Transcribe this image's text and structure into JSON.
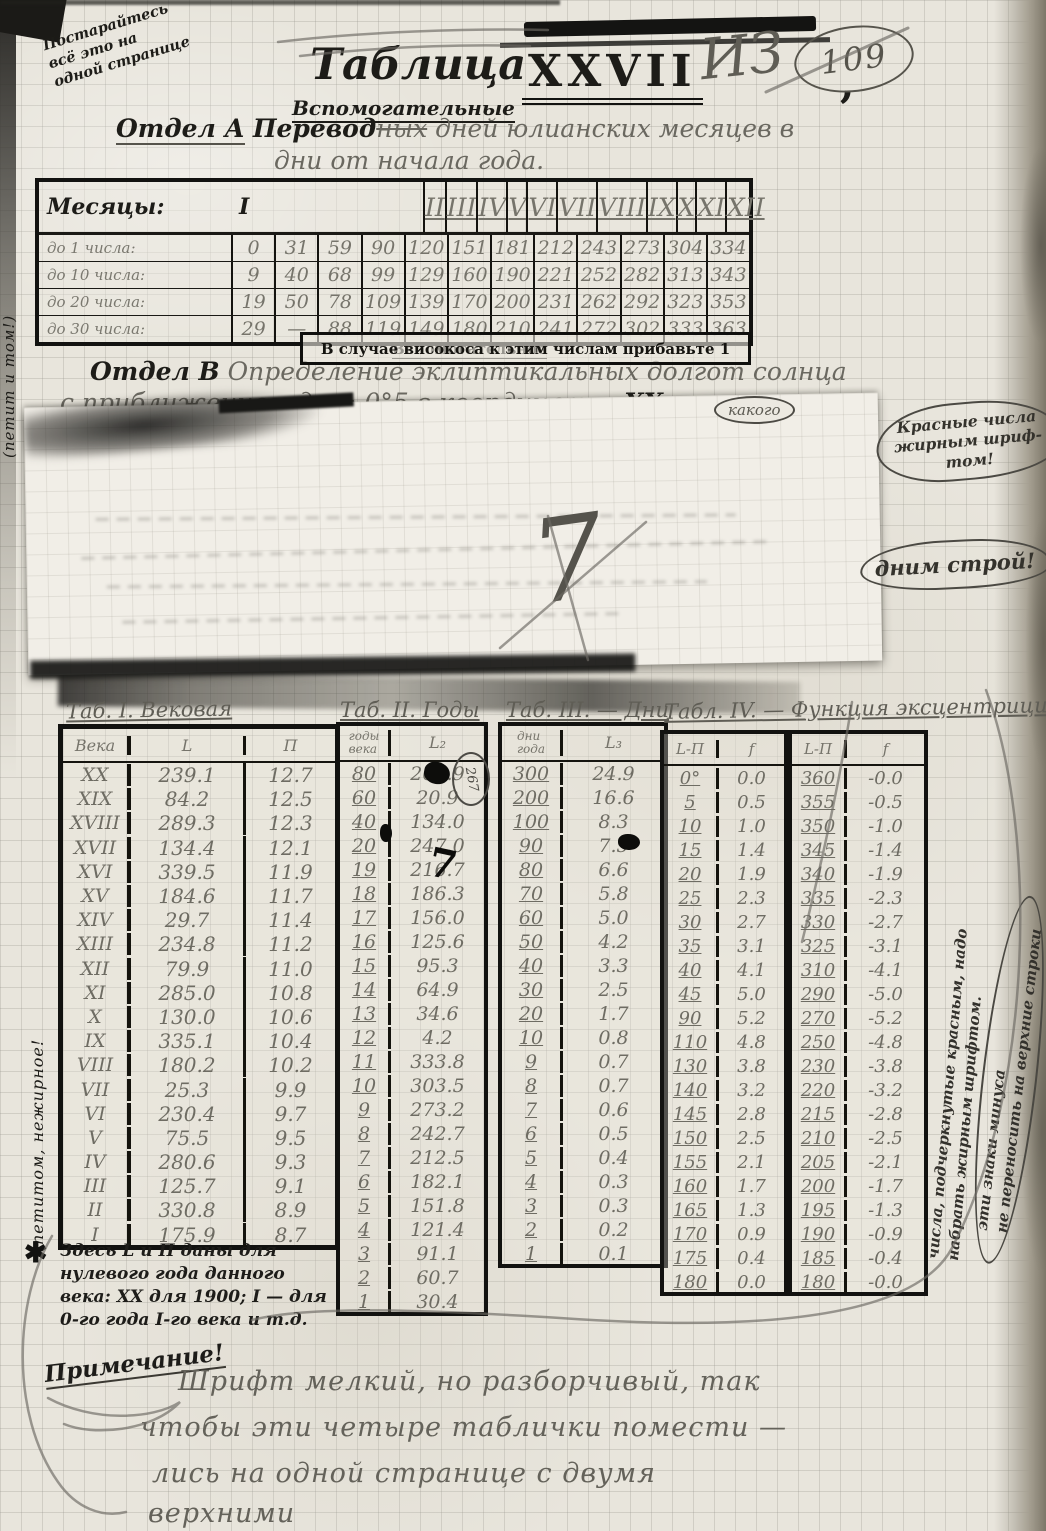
{
  "colors": {
    "paper": "#e8e5dc",
    "ink": "#1d1c18",
    "pencil": "#6a6860"
  },
  "margin_notes": {
    "top_left": "Постарайтесь\nвсё это на\nодной странице",
    "left_vertical_top": "(петит и том!)",
    "left_vertical_mid": "петитом, нежирное!",
    "red_numbers": "Красные числа\nжирным шриф-\nтом!",
    "stroy": "дним строй!",
    "right_line1": "числа, подчеркнутые красным, надо",
    "right_line2": "набрать жирным шрифтом.",
    "right_circled": "эти знаки минуса\nне переносить на верхние строки"
  },
  "header": {
    "title_word": "Таблица",
    "title_number": "XXVII",
    "title_comma": ",",
    "subtitle": "Вспомогательные",
    "pencil_iz": "ИЗ",
    "circled_number": "109",
    "section_a": {
      "prefix": "Отдел А",
      "inserted": "Перевод",
      "struck": "ных",
      "rest": "дней юлианских месяцев в",
      "line2": "дни от начала года."
    },
    "section_b": {
      "inserted": "Вспомогательное",
      "prefix": "Отдел В",
      "line1_rest": "Определение эклиптикальных долгот солнца",
      "line2_a": "с приближением до ± 0°5 в координатах",
      "struck": "XX",
      "line2_b": "века",
      "bubble": "какого"
    }
  },
  "table_a": {
    "corner_label": "Месяцы:",
    "months": [
      "I",
      "II",
      "III",
      "IV",
      "V",
      "VI",
      "VII",
      "VIII",
      "IX",
      "X",
      "XI",
      "XII"
    ],
    "rows": [
      {
        "label": "до 1 числа:",
        "values": [
          "0",
          "31",
          "59",
          "90",
          "120",
          "151",
          "181",
          "212",
          "243",
          "273",
          "304",
          "334"
        ]
      },
      {
        "label": "до 10 числа:",
        "values": [
          "9",
          "40",
          "68",
          "99",
          "129",
          "160",
          "190",
          "221",
          "252",
          "282",
          "313",
          "343"
        ]
      },
      {
        "label": "до 20 числа:",
        "values": [
          "19",
          "50",
          "78",
          "109",
          "139",
          "170",
          "200",
          "231",
          "262",
          "292",
          "323",
          "353"
        ]
      },
      {
        "label": "до 30 числа:",
        "values": [
          "29",
          "—",
          "88",
          "119",
          "149",
          "180",
          "210",
          "241",
          "272",
          "302",
          "333",
          "363"
        ]
      }
    ],
    "leap_note": "В случае високоса к этим числам прибавьте 1"
  },
  "strip": {
    "scribble": "7"
  },
  "table1": {
    "title": "Таб. I. Вековая",
    "headers": [
      "Века",
      "L",
      "П"
    ],
    "rows": [
      [
        "XX",
        "239.1",
        "12.7"
      ],
      [
        "XIX",
        "84.2",
        "12.5"
      ],
      [
        "XVIII",
        "289.3",
        "12.3"
      ],
      [
        "XVII",
        "134.4",
        "12.1"
      ],
      [
        "XVI",
        "339.5",
        "11.9"
      ],
      [
        "XV",
        "184.6",
        "11.7"
      ],
      [
        "XIV",
        "29.7",
        "11.4"
      ],
      [
        "XIII",
        "234.8",
        "11.2"
      ],
      [
        "XII",
        "79.9",
        "11.0"
      ],
      [
        "XI",
        "285.0",
        "10.8"
      ],
      [
        "X",
        "130.0",
        "10.6"
      ],
      [
        "IX",
        "335.1",
        "10.4"
      ],
      [
        "VIII",
        "180.2",
        "10.2"
      ],
      [
        "VII",
        "25.3",
        "9.9"
      ],
      [
        "VI",
        "230.4",
        "9.7"
      ],
      [
        "V",
        "75.5",
        "9.5"
      ],
      [
        "IV",
        "280.6",
        "9.3"
      ],
      [
        "III",
        "125.7",
        "9.1"
      ],
      [
        "II",
        "330.8",
        "8.9"
      ],
      [
        "I",
        "175.9",
        "8.7"
      ]
    ]
  },
  "table2": {
    "title": "Таб. II. Годы",
    "headers": [
      "годы\nвека",
      "L₂"
    ],
    "annotation": "267",
    "rows": [
      [
        "80",
        "267.9"
      ],
      [
        "60",
        "20.9"
      ],
      [
        "40",
        "134.0"
      ],
      [
        "20",
        "247.0"
      ],
      [
        "19",
        "216.7"
      ],
      [
        "18",
        "186.3"
      ],
      [
        "17",
        "156.0"
      ],
      [
        "16",
        "125.6"
      ],
      [
        "15",
        "95.3"
      ],
      [
        "14",
        "64.9"
      ],
      [
        "13",
        "34.6"
      ],
      [
        "12",
        "4.2"
      ],
      [
        "11",
        "333.8"
      ],
      [
        "10",
        "303.5"
      ],
      [
        "9",
        "273.2"
      ],
      [
        "8",
        "242.7"
      ],
      [
        "7",
        "212.5"
      ],
      [
        "6",
        "182.1"
      ],
      [
        "5",
        "151.8"
      ],
      [
        "4",
        "121.4"
      ],
      [
        "3",
        "91.1"
      ],
      [
        "2",
        "60.7"
      ],
      [
        "1",
        "30.4"
      ]
    ]
  },
  "table3": {
    "title": "Таб. III. — Дни",
    "headers": [
      "дни\nгода",
      "L₃"
    ],
    "rows": [
      [
        "300",
        "24.9"
      ],
      [
        "200",
        "16.6"
      ],
      [
        "100",
        "8.3"
      ],
      [
        "90",
        "7.5"
      ],
      [
        "80",
        "6.6"
      ],
      [
        "70",
        "5.8"
      ],
      [
        "60",
        "5.0"
      ],
      [
        "50",
        "4.2"
      ],
      [
        "40",
        "3.3"
      ],
      [
        "30",
        "2.5"
      ],
      [
        "20",
        "1.7"
      ],
      [
        "10",
        "0.8"
      ],
      [
        "9",
        "0.7"
      ],
      [
        "8",
        "0.7"
      ],
      [
        "7",
        "0.6"
      ],
      [
        "6",
        "0.5"
      ],
      [
        "5",
        "0.4"
      ],
      [
        "4",
        "0.3"
      ],
      [
        "3",
        "0.3"
      ],
      [
        "2",
        "0.2"
      ],
      [
        "1",
        "0.1"
      ]
    ]
  },
  "table4": {
    "title": "Табл. IV. — Функция эксцентрицитета",
    "headers": [
      "L-П",
      "f"
    ],
    "left_rows": [
      [
        "0°",
        "0.0"
      ],
      [
        "5",
        "0.5"
      ],
      [
        "10",
        "1.0"
      ],
      [
        "15",
        "1.4"
      ],
      [
        "20",
        "1.9"
      ],
      [
        "25",
        "2.3"
      ],
      [
        "30",
        "2.7"
      ],
      [
        "35",
        "3.1"
      ],
      [
        "40",
        "4.1"
      ],
      [
        "45",
        "5.0"
      ],
      [
        "90",
        "5.2"
      ],
      [
        "110",
        "4.8"
      ],
      [
        "130",
        "3.8"
      ],
      [
        "140",
        "3.2"
      ],
      [
        "145",
        "2.8"
      ],
      [
        "150",
        "2.5"
      ],
      [
        "155",
        "2.1"
      ],
      [
        "160",
        "1.7"
      ],
      [
        "165",
        "1.3"
      ],
      [
        "170",
        "0.9"
      ],
      [
        "175",
        "0.4"
      ],
      [
        "180",
        "0.0"
      ]
    ],
    "right_rows": [
      [
        "360",
        "-0.0"
      ],
      [
        "355",
        "-0.5"
      ],
      [
        "350",
        "-1.0"
      ],
      [
        "345",
        "-1.4"
      ],
      [
        "340",
        "-1.9"
      ],
      [
        "335",
        "-2.3"
      ],
      [
        "330",
        "-2.7"
      ],
      [
        "325",
        "-3.1"
      ],
      [
        "310",
        "-4.1"
      ],
      [
        "290",
        "-5.0"
      ],
      [
        "270",
        "-5.2"
      ],
      [
        "250",
        "-4.8"
      ],
      [
        "230",
        "-3.8"
      ],
      [
        "220",
        "-3.2"
      ],
      [
        "215",
        "-2.8"
      ],
      [
        "210",
        "-2.5"
      ],
      [
        "205",
        "-2.1"
      ],
      [
        "200",
        "-1.7"
      ],
      [
        "195",
        "-1.3"
      ],
      [
        "190",
        "-0.9"
      ],
      [
        "185",
        "-0.4"
      ],
      [
        "180",
        "-0.0"
      ]
    ]
  },
  "footnote": {
    "star": "✱",
    "text": "Здесь L и П даны для\nнулевого года данного\nвека: XX для 1900; I — для\n0-го года I-го века и т.д."
  },
  "bottom": {
    "label": "Примечание!",
    "line1": "Шрифт мелкий, но разборчивый, так",
    "line2": "чтобы эти четыре таблички помести —",
    "line3": "лись на одной странице с двумя",
    "line4": "верхними"
  }
}
